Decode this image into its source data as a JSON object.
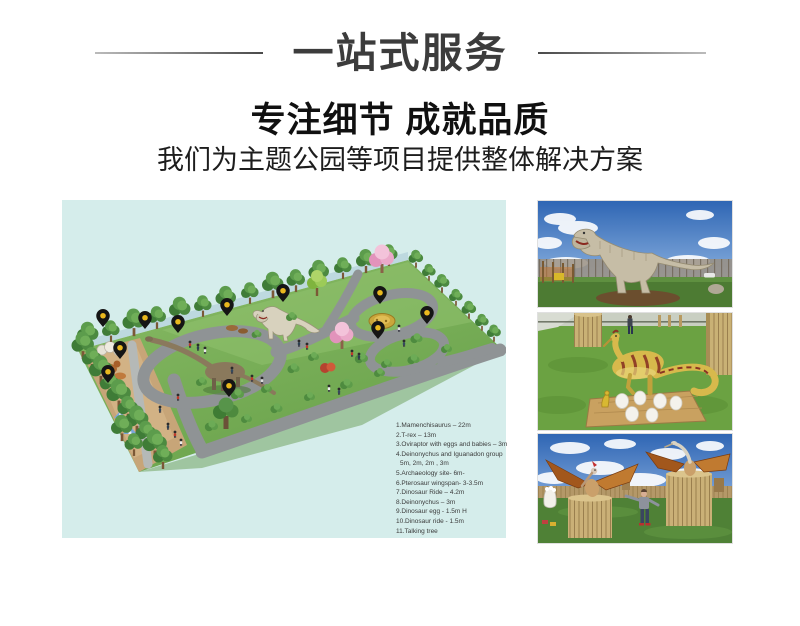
{
  "header": {
    "banner_title": "一站式服务",
    "headline": "专注细节 成就品质",
    "subheadline": "我们为主题公园等项目提供整体解决方案"
  },
  "map": {
    "background_color": "#d5edeb",
    "grass_color": "#7cb05a",
    "path_color": "#8f9395",
    "pin_color": "#151515",
    "pin_dot_color": "#eab81e",
    "pin_count": 11,
    "legend": [
      "1.Mamenchisaurus – 22m",
      "2.T-rex – 13m",
      "3.Oviraptor with eggs and babies – 3m",
      "4.Deinonychus and Iguanadon group",
      "5m, 2m, 2m , 3m",
      "5.Archaeology site- 6m-",
      "6.Pterosaur  wingspan- 3-3.5m",
      "7.Dinosaur Ride – 4.2m",
      "8.Deinonychus – 3m",
      "9.Dinosaur egg - 1.5m H",
      "10.Dinosaur ride -  1.5m",
      "11.Talking tree"
    ]
  }
}
